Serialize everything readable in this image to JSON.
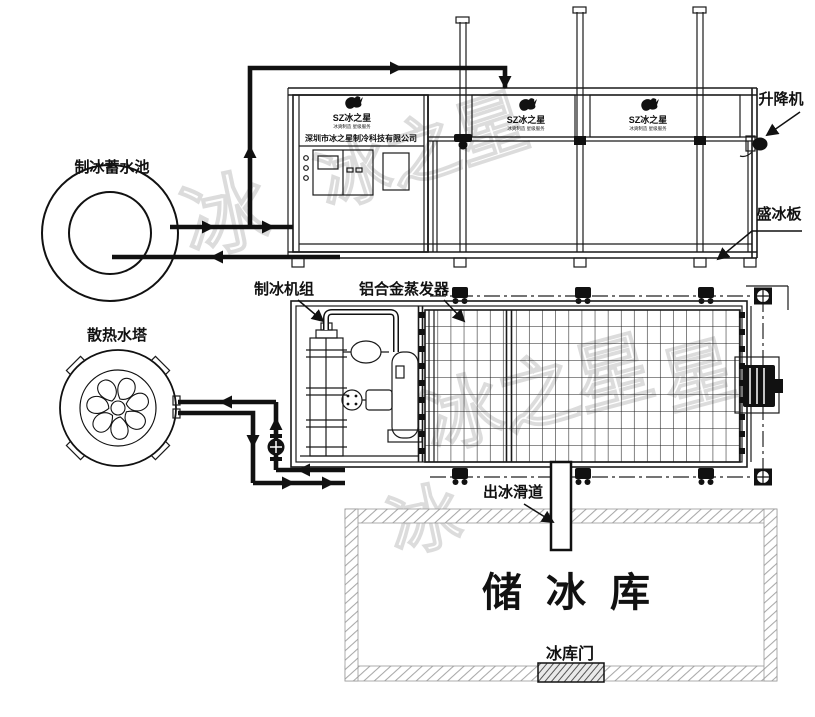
{
  "labels": {
    "lift": "升降机",
    "pool": "制冰蓄水池",
    "ice_plate": "盛冰板",
    "machine_unit": "制冰机组",
    "evaporator": "铝合金蒸发器",
    "cooling_tower": "散热水塔",
    "ice_slide": "出冰滑道",
    "storage": "储冰库",
    "storage_door": "冰库门"
  },
  "brand": {
    "logo_text": "SZ冰之星",
    "slogan": "冰爽制造 星级服务",
    "company": "深圳市冰之星制冷科技有限公司"
  },
  "watermark": {
    "text": "冰之星",
    "char1": "冰",
    "char2": "星"
  },
  "colors": {
    "line": "#1a1a1a",
    "wall_hatch": "#a8a8a8",
    "door_hatch": "#555555",
    "watermark": "#d9d9d9"
  }
}
